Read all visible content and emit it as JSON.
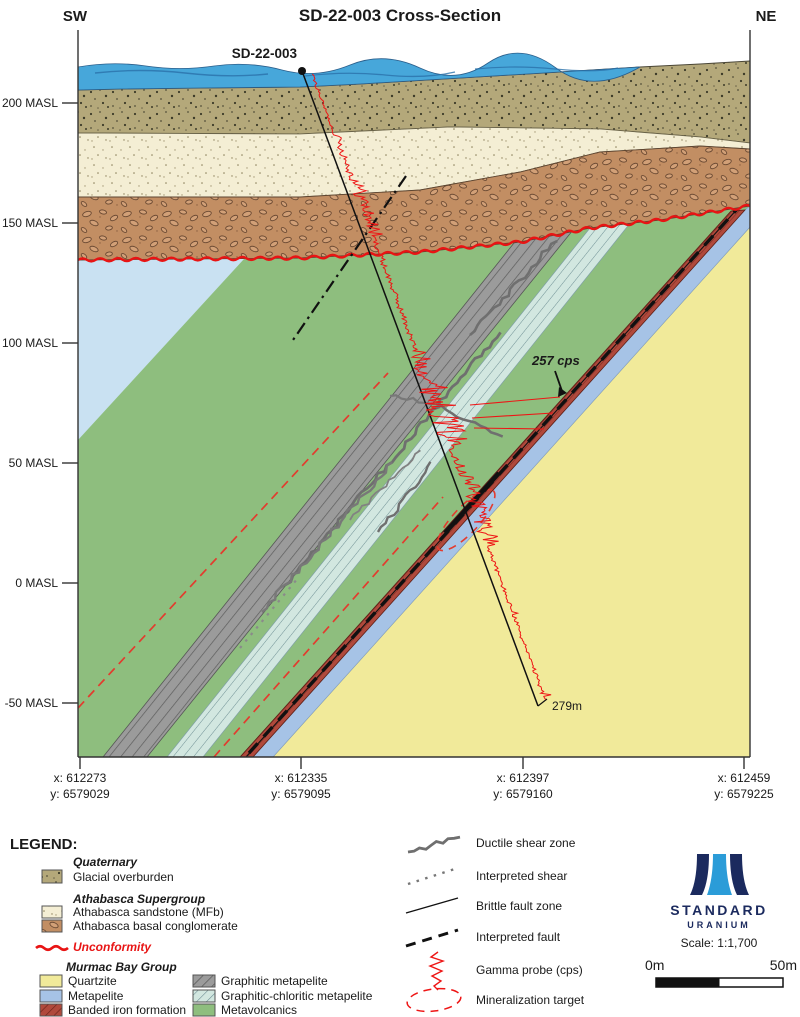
{
  "title": "SD-22-003 Cross-Section",
  "orientation": {
    "left": "SW",
    "right": "NE"
  },
  "axis": {
    "masl": [
      "200 MASL",
      "150 MASL",
      "100 MASL",
      "50 MASL",
      "0 MASL",
      "-50 MASL"
    ],
    "coords": [
      {
        "x": "x: 612273",
        "y": "y: 6579029"
      },
      {
        "x": "x: 612335",
        "y": "y: 6579095"
      },
      {
        "x": "x: 612397",
        "y": "y: 6579160"
      },
      {
        "x": "x: 612459",
        "y": "y: 6579225"
      }
    ]
  },
  "annotations": {
    "drill_label": "SD-22-003",
    "peak_label": "257 cps",
    "depth_label": "279m"
  },
  "legend": {
    "heading": "LEGEND:",
    "groups": [
      {
        "title": "Quaternary",
        "items": [
          {
            "label": "Glacial overburden",
            "color": "#b4a87a"
          }
        ]
      },
      {
        "title": "Athabasca Supergroup",
        "items": [
          {
            "label": "Athabasca sandstone (MFb)",
            "color": "#f4eed4"
          },
          {
            "label": "Athabasca basal conglomerate",
            "color": "#c28e63"
          }
        ]
      },
      {
        "title": "Murmac Bay Group",
        "items": [
          {
            "label": "Quartzite",
            "color": "#f1ea9a"
          },
          {
            "label": "Metapelite",
            "color": "#a6c3e6"
          },
          {
            "label": "Banded iron formation",
            "color": "#b0493c"
          },
          {
            "label": "Graphitic metapelite",
            "color": "#9b9b9b"
          },
          {
            "label": "Graphitic-chloritic metapelite",
            "color": "#d2e7e0"
          },
          {
            "label": "Metavolcanics",
            "color": "#8ebe7e"
          }
        ]
      }
    ],
    "unconformity": {
      "label": "Unconformity",
      "color": "#e81414"
    },
    "symbols": [
      {
        "label": "Ductile shear zone"
      },
      {
        "label": "Interpreted shear"
      },
      {
        "label": "Brittle fault zone"
      },
      {
        "label": "Interpreted fault"
      },
      {
        "label": "Gamma probe (cps)"
      },
      {
        "label": "Mineralization target"
      }
    ]
  },
  "logo": {
    "name": "STANDARD",
    "sub": "URANIUM",
    "navy": "#1b2a5e",
    "blue": "#2b9cd8"
  },
  "scale": {
    "text": "Scale: 1:1,700",
    "left": "0m",
    "right": "50m"
  },
  "colors": {
    "water": "#47a7da",
    "water_streak": "#2a72aa",
    "overburden": "#b4a87a",
    "sandstone": "#f4eed4",
    "conglomerate": "#c28e63",
    "unconformity": "#e81414",
    "metavolcanics": "#8ebe7e",
    "graphitic_metapelite": "#9b9b9b",
    "graphitic_chloritic": "#d2e7e0",
    "banded_iron": "#b0493c",
    "metapelite_band": "#a6c3e6",
    "metapelite_wedge": "#c9e1f2",
    "quartzite": "#f1ea9a",
    "gamma": "#ee1515"
  }
}
